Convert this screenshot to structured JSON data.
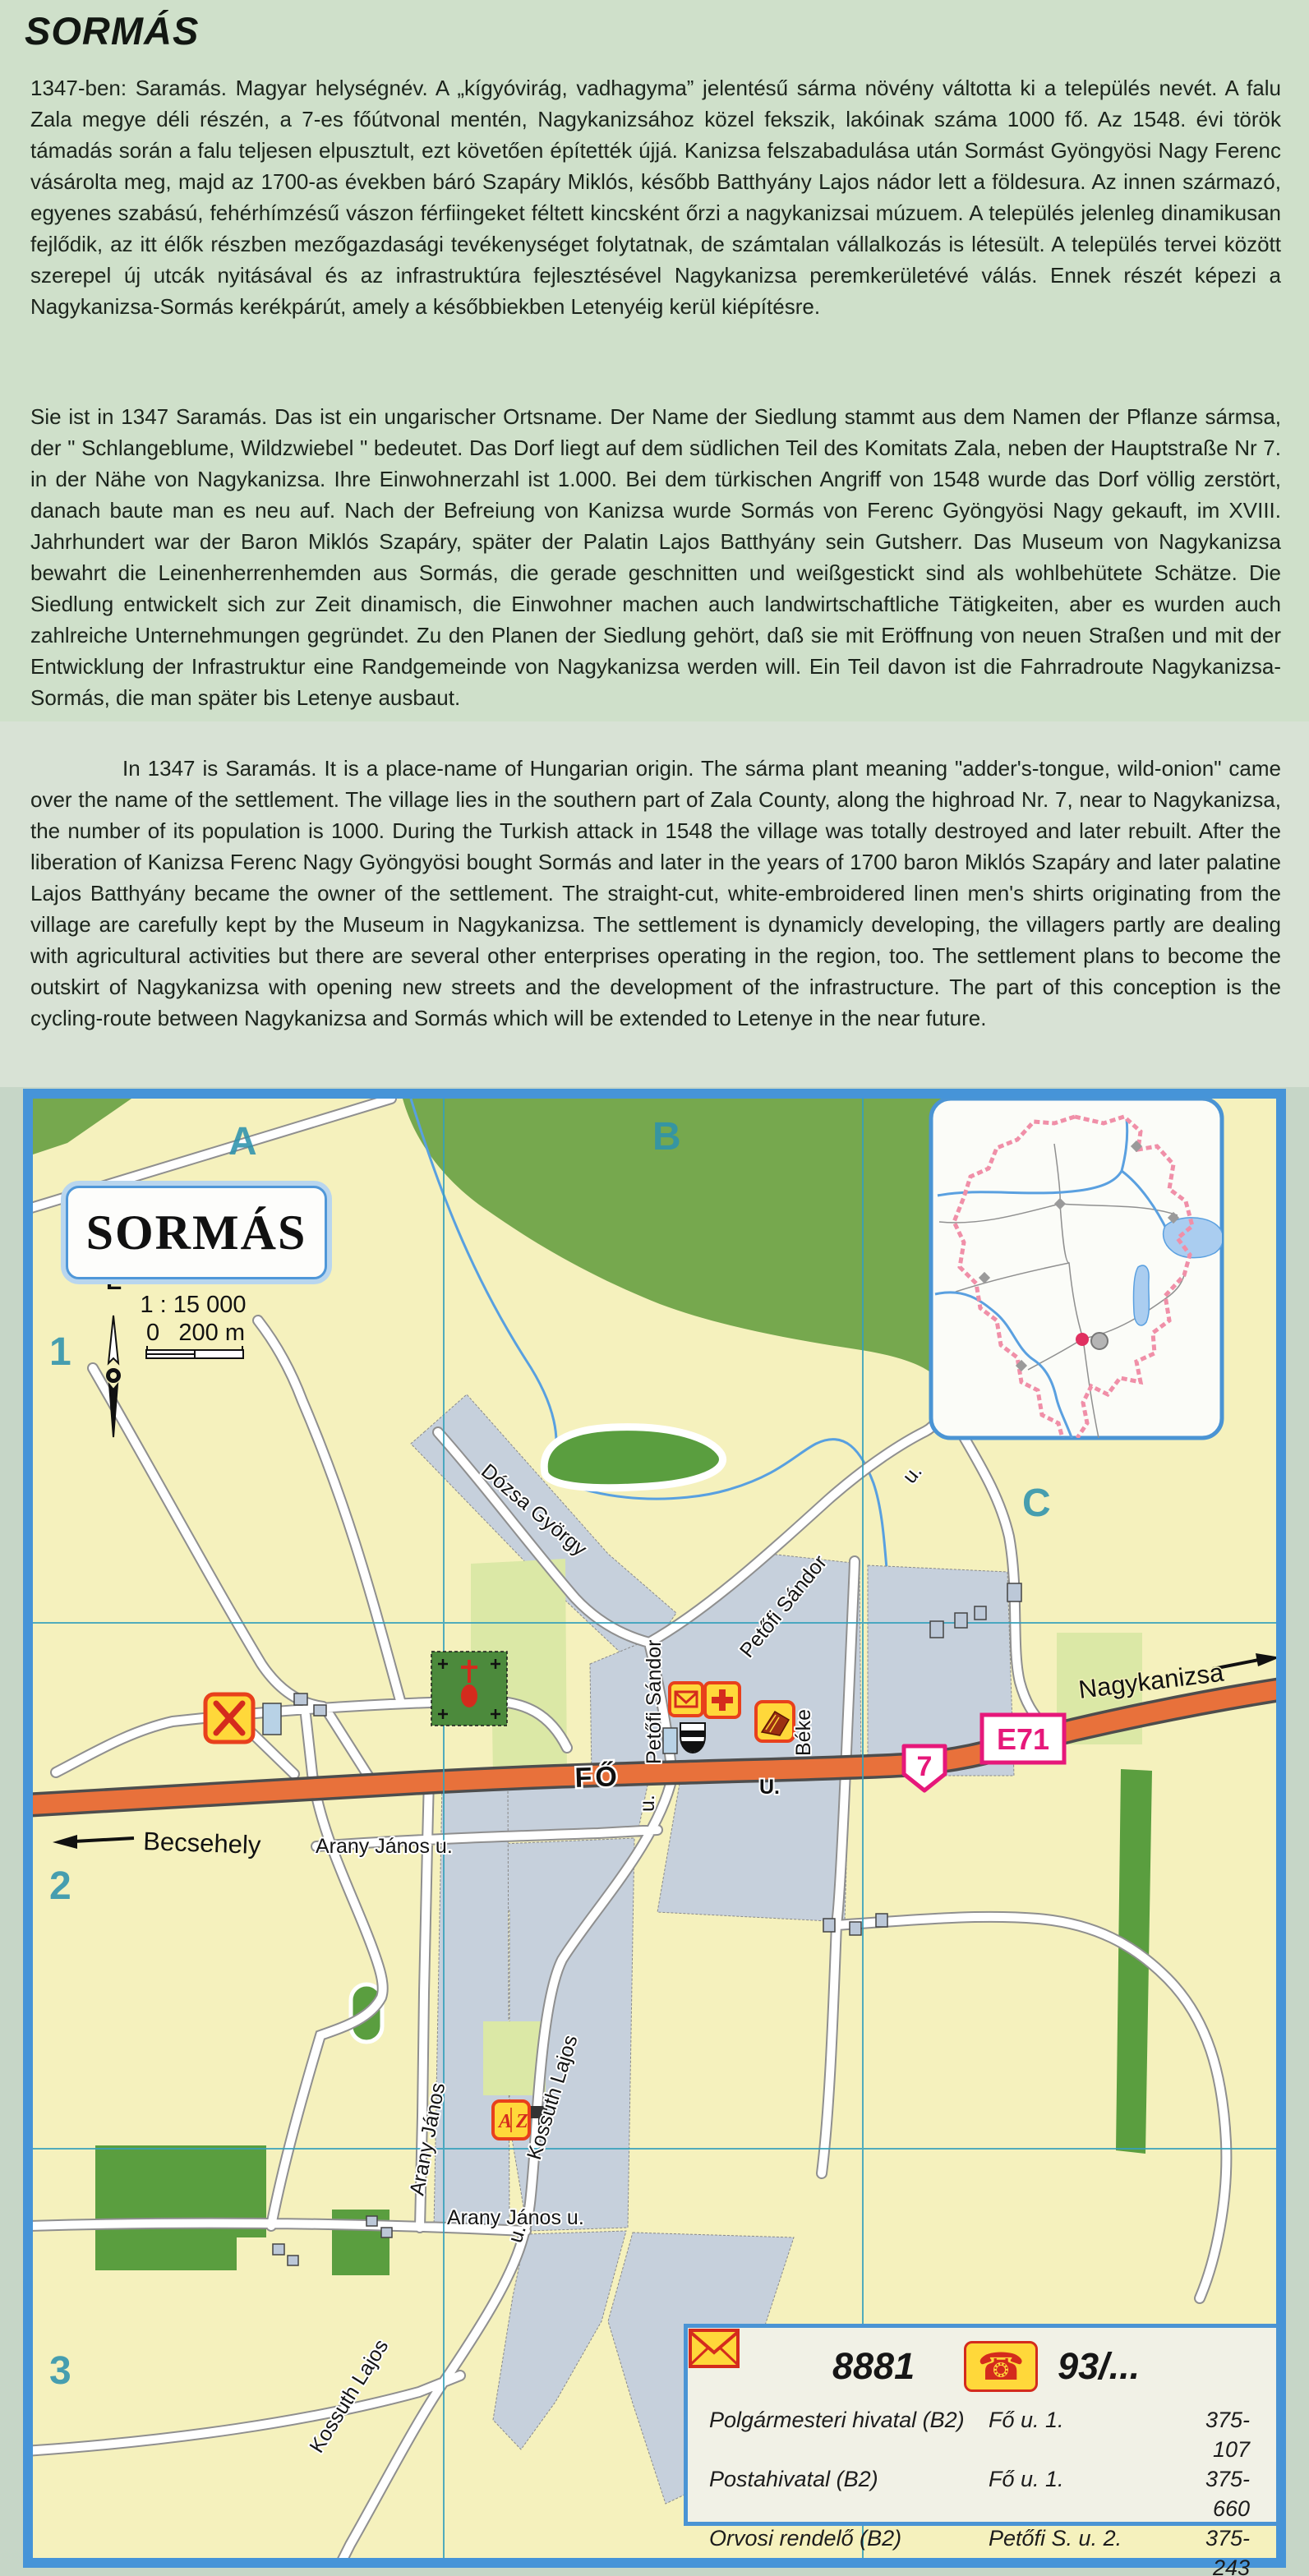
{
  "page": {
    "title": "SORMÁS"
  },
  "paragraphs": {
    "hungarian": "1347-ben: Saramás. Magyar helységnév. A „kígyóvirág, vadhagyma” jelentésű sárma növény váltotta ki a település nevét. A falu Zala megye déli részén, a 7-es főútvonal mentén, Nagykanizsához közel fekszik, lakóinak száma 1000 fő. Az 1548. évi török támadás során a falu teljesen elpusztult, ezt követően építették újjá. Kanizsa felszabadulása után Sormást Gyöngyösi Nagy Ferenc vásárolta meg, majd az 1700-as években báró Szapáry Miklós, később Batthyány Lajos nádor lett a földesura. Az innen származó, egyenes szabású, fehérhímzésű vászon férfiingeket féltett kincsként őrzi a nagykanizsai múzuem. A település jelenleg dinamikusan fejlődik, az itt élők részben mezőgazdasági tevékenységet folytatnak, de számtalan vállalkozás is létesült.  A település tervei között szerepel új utcák nyitásával és az infrastruktúra fejlesztésével Nagykanizsa peremkerületévé válás. Ennek részét képezi a Nagykanizsa-Sormás kerékpárút, amely a későbbiekben Letenyéig kerül kiépítésre.",
    "german": "Sie ist in 1347 Saramás. Das ist ein ungarischer Ortsname. Der Name der Siedlung stammt aus dem Namen der Pflanze sármsa, der \" Schlangeblume, Wildzwiebel \" bedeutet. Das Dorf liegt auf dem südlichen Teil des Komitats Zala, neben der Hauptstraße Nr 7. in der Nähe von Nagykanizsa. Ihre Einwohnerzahl ist 1.000. Bei dem türkischen Angriff von 1548 wurde das Dorf völlig zerstört, danach baute man es neu auf. Nach der Befreiung von Kanizsa wurde Sormás von Ferenc Gyöngyösi Nagy gekauft, im XVIII. Jahrhundert war der Baron Miklós Szapáry, später der Palatin Lajos Batthyány sein Gutsherr. Das Museum von Nagykanizsa bewahrt die Leinenherrenhemden aus Sormás, die gerade geschnitten und weißgestickt sind als  wohlbehütete Schätze. Die Siedlung entwickelt sich zur Zeit dinamisch, die Einwohner machen auch landwirtschaftliche Tätigkeiten, aber es wurden auch zahlreiche Unternehmungen gegründet. Zu den Planen der Siedlung gehört, daß sie mit Eröffnung von neuen Straßen und mit der Entwicklung der Infrastruktur eine Randgemeinde von Nagykanizsa werden will. Ein Teil davon ist die Fahrradroute Nagykanizsa-Sormás, die man später bis Letenye ausbaut.",
    "english": "In 1347 is Saramás. It is a place-name of Hungarian origin. The sárma plant meaning \"adder's-tongue, wild-onion\" came over the name of the settlement. The village lies in the southern part of Zala County, along the highroad Nr. 7, near to Nagykanizsa, the number of its population is 1000. During the Turkish attack in 1548 the village was totally destroyed and later rebuilt. After the liberation of Kanizsa Ferenc Nagy Gyöngyösi bought Sormás and later in the years of 1700 baron Miklós Szapáry and later palatine Lajos Batthyány became the owner of the settlement. The straight-cut, white-embroidered linen men's shirts originating from the village are carefully kept by the Museum in Nagykanizsa. The settlement is dynamicly developing, the villagers partly are dealing with agricultural activities but there are several other enterprises operating in the region, too. The settlement plans to become the outskirt of Nagykanizsa with opening new streets and the development of the infrastructure. The part of this conception is the cycling-route between Nagykanizsa and Sormás which will be extended to Letenye in the near future."
  },
  "map": {
    "title": "SORMÁS",
    "scale": {
      "ratio": "1 : 15 000",
      "zero": "0",
      "end": "200 m"
    },
    "north": "É",
    "grid": {
      "cols": [
        "A",
        "B",
        "C"
      ],
      "rows": [
        "1",
        "2",
        "3"
      ]
    },
    "directions": {
      "west": "Becsehely",
      "east": "Nagykanizsa"
    },
    "shields": {
      "national": "7",
      "european": "E71"
    },
    "streets": {
      "fo": "FŐ",
      "fo_u": "U.",
      "dozsa": "Dózsa György",
      "petofi_diag": "Petőfi Sándor",
      "petofi_diag_u": "u.",
      "petofi_vert": "Petőfi Sándor",
      "petofi_vert_u": "u.",
      "beke": "Béke",
      "arany_1": "Arany János  u.",
      "arany_vert": "Arany János",
      "arany_2": "Arany János  u.",
      "kossuth_1": "Kossuth Lajos",
      "kossuth_u": "u.",
      "kossuth_2": "Kossuth Lajos"
    },
    "school_icon_letters": "AZ",
    "colors": {
      "border": "#4694d8",
      "road_orange": "#e8713b",
      "shield_pink": "#e6187a",
      "grid_teal": "#35a0bc",
      "forest": "#76a84e",
      "builtup": "#c6d0dc",
      "cream": "#f5f1bd"
    }
  },
  "legend": {
    "postal_code": "8881",
    "phone_prefix": "93/...",
    "rows": [
      {
        "name": "Polgármesteri hivatal (B2)",
        "address": "Fő u. 1.",
        "phone": "375-107"
      },
      {
        "name": "Postahivatal (B2)",
        "address": "Fő u. 1.",
        "phone": "375-660"
      },
      {
        "name": "Orvosi rendelő (B2)",
        "address": "Petőfi S. u. 2.",
        "phone": "375-243"
      }
    ],
    "population_label": "Lakosságszám:",
    "population_value": "1000"
  }
}
